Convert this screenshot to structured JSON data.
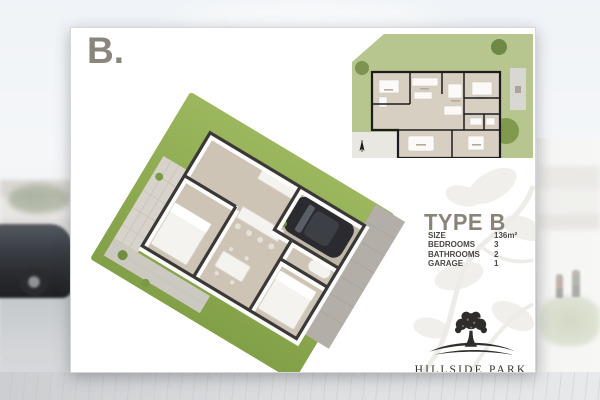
{
  "card": {
    "label": "B.",
    "plan": {
      "title": "TYPE B",
      "specs": [
        {
          "label": "SIZE",
          "value": "136m²"
        },
        {
          "label": "BEDROOMS",
          "value": "3"
        },
        {
          "label": "BATHROOMS",
          "value": "2"
        },
        {
          "label": "GARAGE",
          "value": "1"
        }
      ]
    },
    "brand": {
      "name": "HILLSIDE PARK"
    }
  },
  "icons": {
    "tree_logo": "tree-over-hills-logo",
    "north_arrow": "north-arrow-compass",
    "watermark": "faint-tree-leaf-pattern"
  },
  "colors": {
    "lawn_green_3d": "#8fae52",
    "site_lawn_green": "#b7c58e",
    "floor_beige": "#cdc4b6",
    "wall_dark": "#3a3836",
    "title_gray": "#8a8379",
    "spec_text": "#4b4843",
    "driveway_gray": "#b3afa8"
  }
}
